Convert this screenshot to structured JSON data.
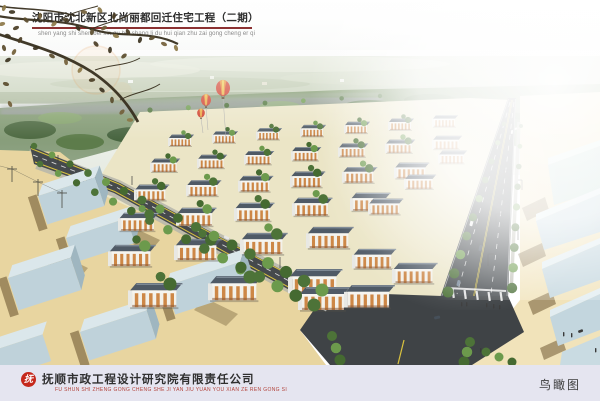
{
  "header": {
    "title": "沈阳市沈北新区北尚丽都回迁住宅工程（二期）",
    "pinyin": "shen yang shi shen bei xin qu bei shang li du hui qian zhu zai gong cheng er qi",
    "underline_color": "#8b3131"
  },
  "footer": {
    "company": "抚顺市政工程设计研究院有限责任公司",
    "company_pinyin": "FU SHUN SHI ZHENG GONG CHENG SHE JI YAN JIU YUAN YOU XIAN ZE REN GONG SI",
    "caption": "鸟瞰图",
    "logo_glyph": "抚",
    "bar_color": "#e5e5f0",
    "pinyin_color": "#b2423a"
  },
  "scene": {
    "palette": {
      "sky": "#f4f6f4",
      "distant_fields": "#c6d0b8",
      "forest": "#5f7d4f",
      "site_ground": "#ebe5c6",
      "open_ground_tan": "#e8d5a0",
      "asphalt": "#42474b",
      "lane_yellow": "#d9c23f",
      "apartment_roof": "#4f5a66",
      "apartment_facade_orange": "#cd8746",
      "warehouse_blue": "#bfd2da",
      "tree_green": "#4d7338",
      "balloon_red": "#cf3b28",
      "balloon_orange": "#e6862f",
      "balloon_yellow": "#ecc94c",
      "shadow_brown": "#6f5a33"
    }
  }
}
